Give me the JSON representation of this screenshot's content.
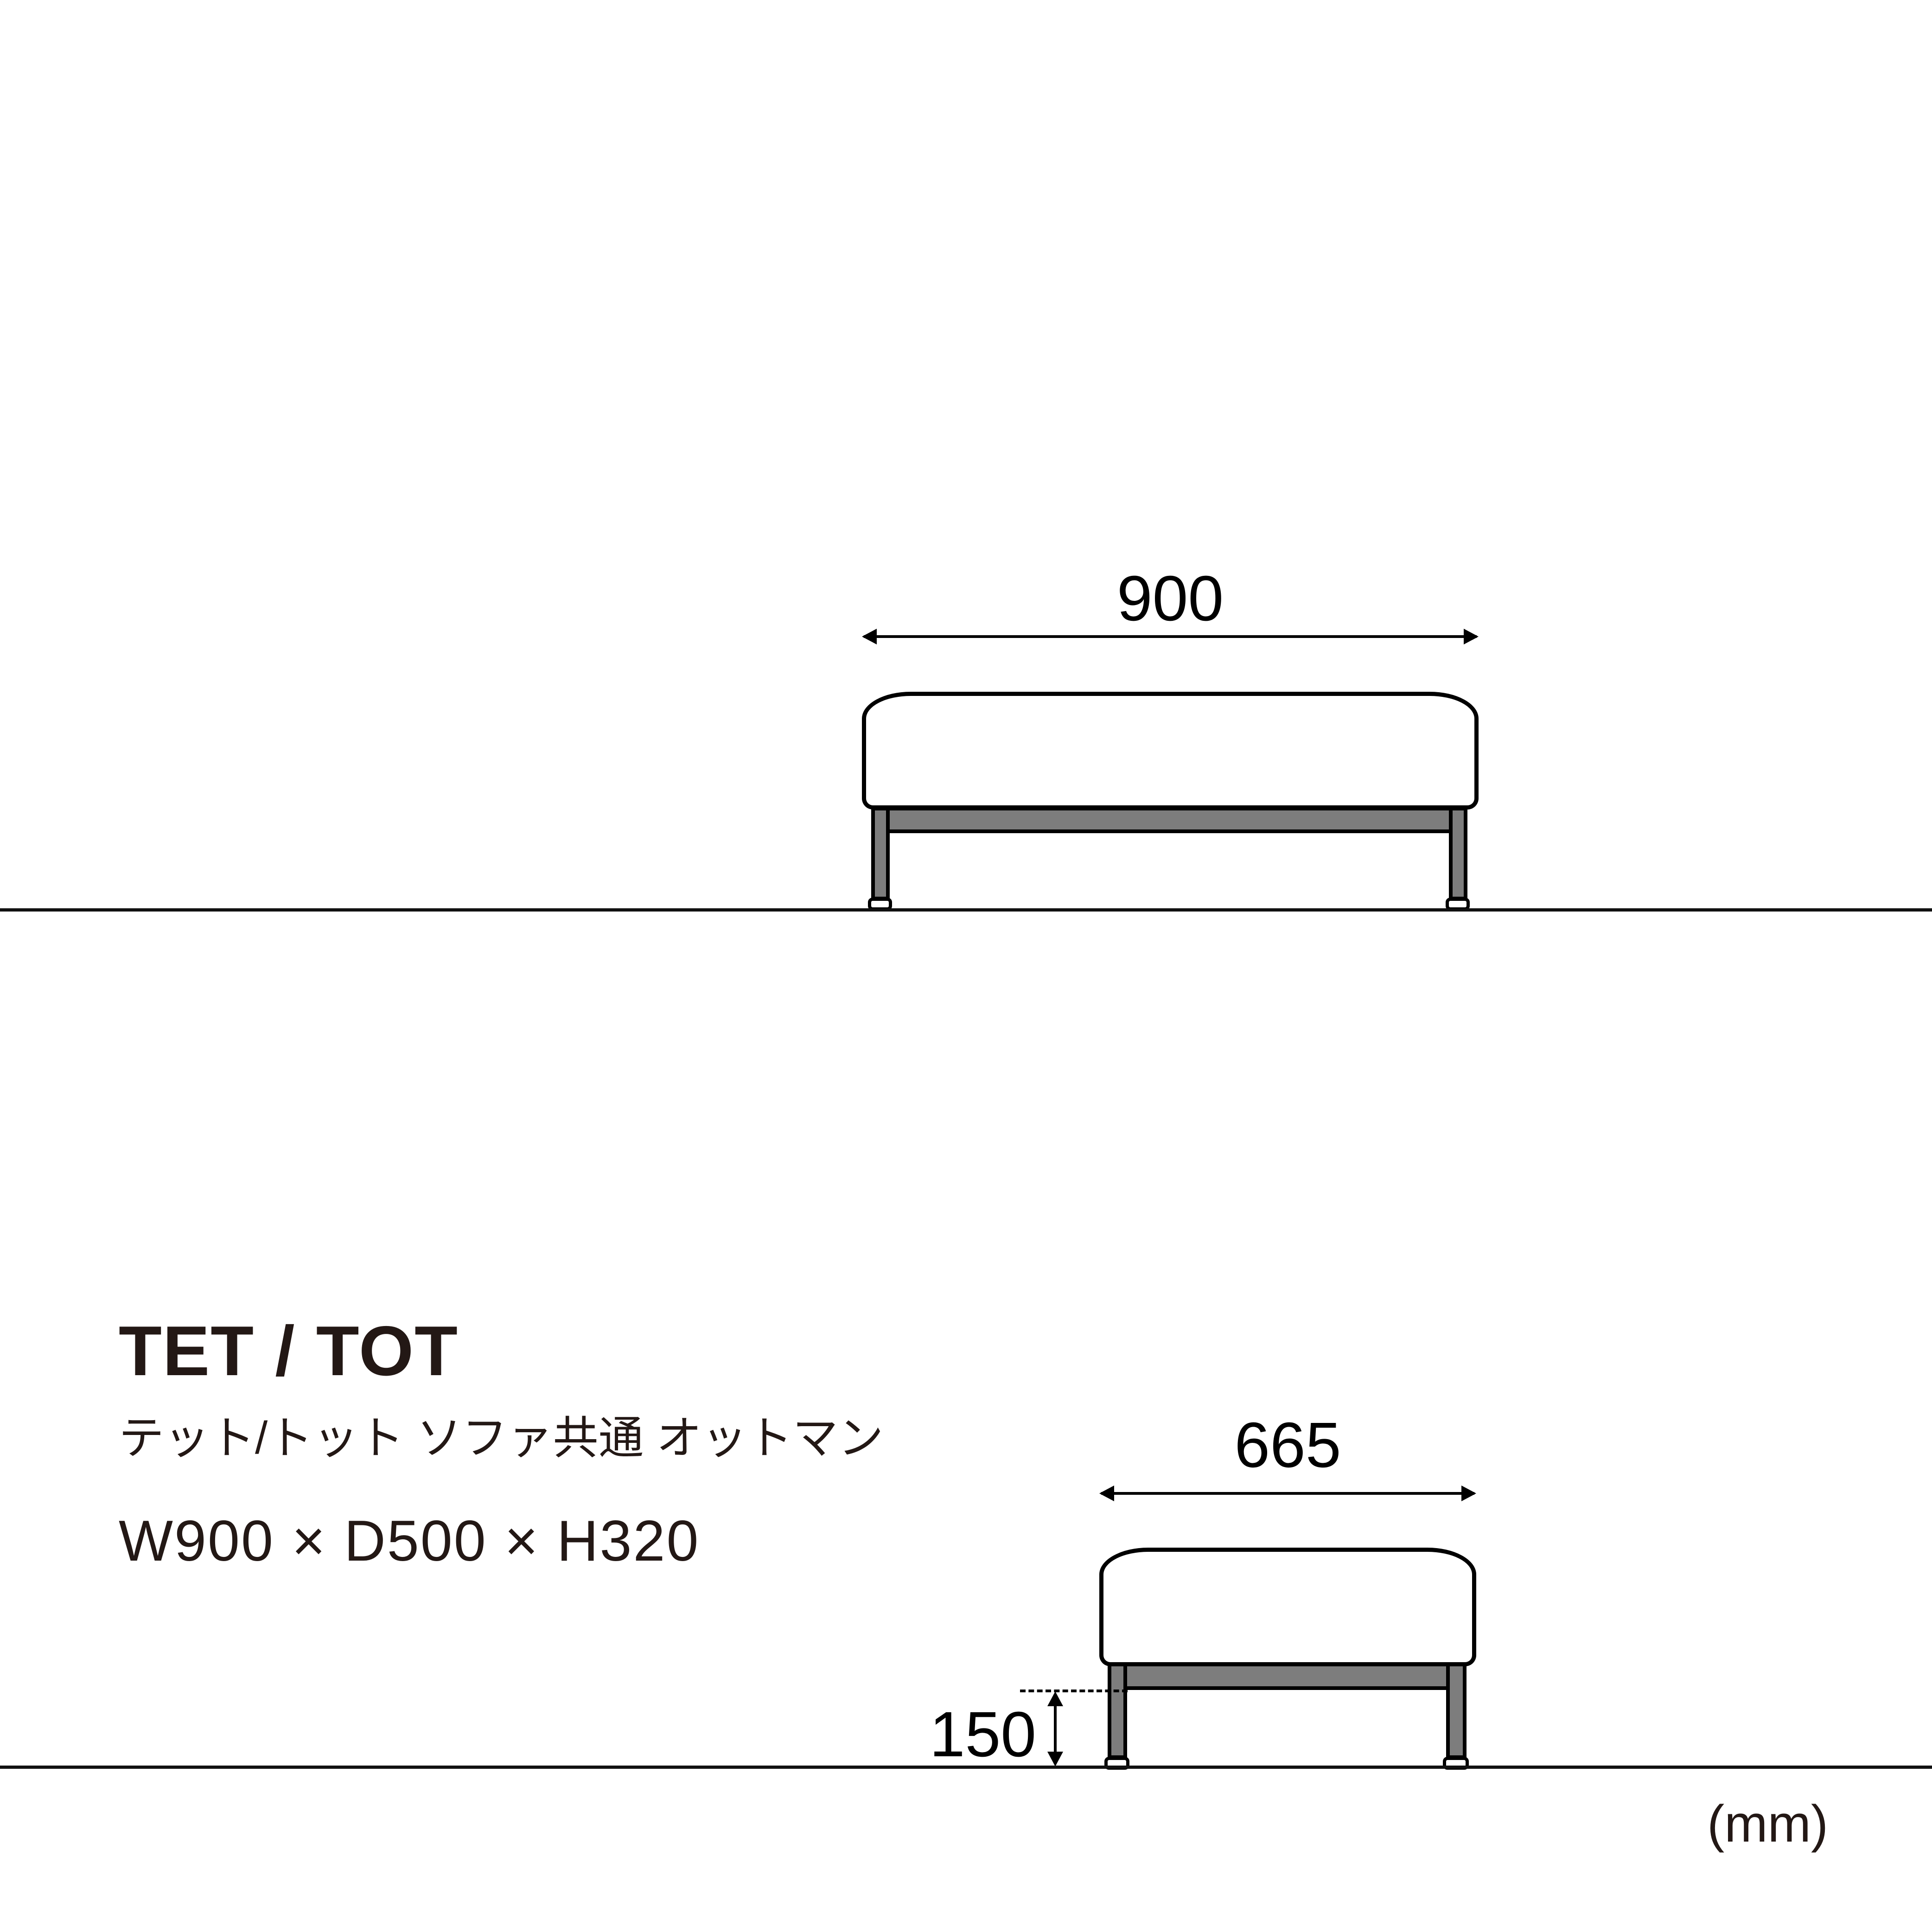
{
  "product": {
    "title": "TET / TOT",
    "subtitle": "テット/トット ソファ共通 オットマン",
    "size_label": "W900 × D500 × H320",
    "unit_label": "(mm)"
  },
  "front_view": {
    "width_label": "900"
  },
  "side_view": {
    "width_label": "665",
    "height_label": "150"
  },
  "colors": {
    "line": "#000000",
    "frame_gray": "#7d7d7d",
    "text": "#231815",
    "background": "#ffffff"
  }
}
